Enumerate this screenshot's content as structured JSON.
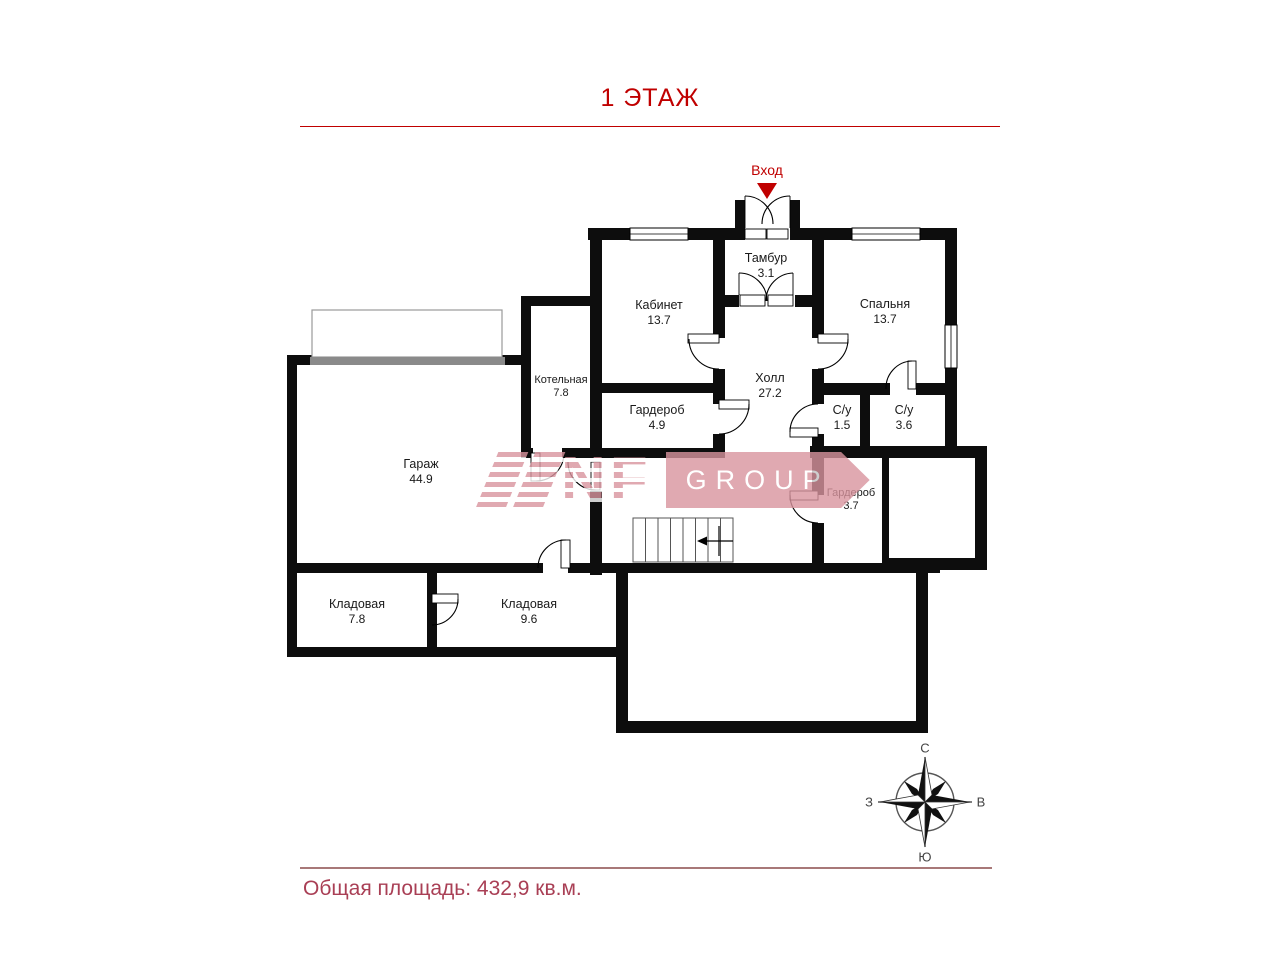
{
  "title": "1 ЭТАЖ",
  "entrance_label": "Вход",
  "rooms": [
    {
      "name": "Тамбур",
      "area": "3.1"
    },
    {
      "name": "Кабинет",
      "area": "13.7"
    },
    {
      "name": "Спальня",
      "area": "13.7"
    },
    {
      "name": "Котельная",
      "area": "7.8"
    },
    {
      "name": "Гардероб",
      "area": "4.9"
    },
    {
      "name": "Холл",
      "area": "27.2"
    },
    {
      "name": "С/у",
      "area": "1.5"
    },
    {
      "name": "С/у",
      "area": "3.6"
    },
    {
      "name": "Гараж",
      "area": "44.9"
    },
    {
      "name": "Гардероб",
      "area": "3.7"
    },
    {
      "name": "Кладовая",
      "area": "7.8"
    },
    {
      "name": "Кладовая",
      "area": "9.6"
    }
  ],
  "watermark": {
    "nf": "NF",
    "group": "GROUP"
  },
  "compass": {
    "north": "С",
    "south": "Ю",
    "west": "З",
    "east": "В"
  },
  "footer": {
    "text": "Общая площадь: 432,9 кв.м."
  },
  "colors": {
    "accent": "#c00000",
    "footer_text": "#a93f55",
    "footer_line": "#a87878",
    "watermark": "#d9949e",
    "walls": "#0d0d0d"
  }
}
